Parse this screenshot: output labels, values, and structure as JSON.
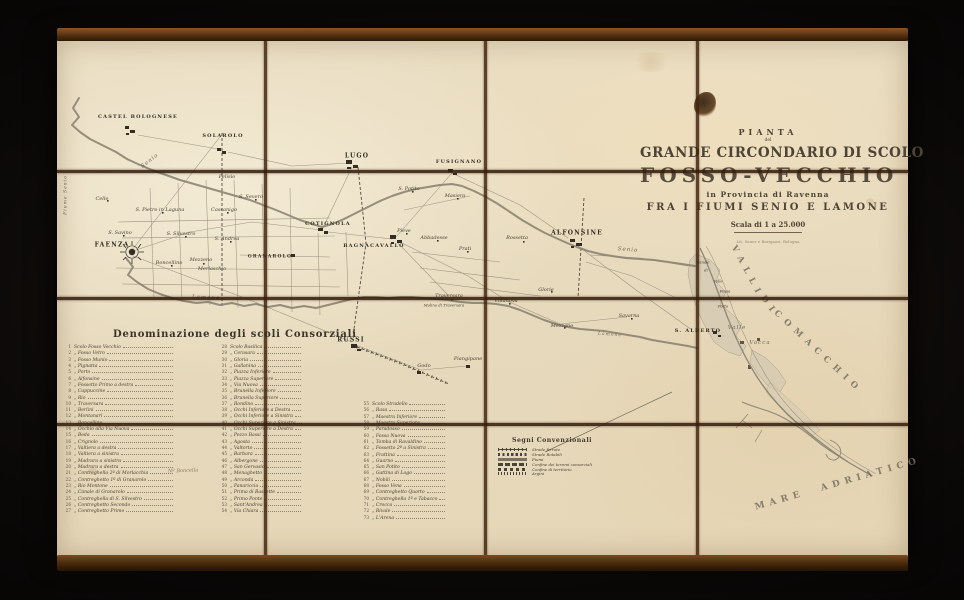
{
  "photo": {
    "paper_color": "#e9ddc1",
    "frame_color": "#51300f",
    "ink_color": "#3f392e",
    "background_color": "#0a0807"
  },
  "title_block": {
    "pianta": "PIANTA",
    "del": "del",
    "line1": "GRANDE CIRCONDARIO DI SCOLO",
    "line2": "FOSSO-VECCHIO",
    "line3": "in Provincia di Ravenna",
    "line4": "FRA I FIUMI SENIO E LAMONE",
    "scala": "Scala di 1 a 25.000",
    "imprint": "Lit. Sauer e Barigazzi, Bologna"
  },
  "scoli": {
    "heading": "Denominazione degli scoli Consorziali",
    "note": "Nº Boncella",
    "col1": [
      {
        "n": "1",
        "name": "Scolo Fosso Vecchio"
      },
      {
        "n": "2",
        "name": "„ Fosso Vetro"
      },
      {
        "n": "3",
        "name": "„ Fosso Munio"
      },
      {
        "n": "4",
        "name": "„ Pignatta"
      },
      {
        "n": "5",
        "name": "„ Porto"
      },
      {
        "n": "6",
        "name": "„ Alfonsine"
      },
      {
        "n": "7",
        "name": "„ Fossetto Primo a destra"
      },
      {
        "n": "8",
        "name": "„ Cappuccine"
      },
      {
        "n": "9",
        "name": "„ Rio"
      },
      {
        "n": "10",
        "name": "„ Traversara"
      },
      {
        "n": "11",
        "name": "„ Berlini"
      },
      {
        "n": "12",
        "name": "„ Montanari"
      },
      {
        "n": "13",
        "name": "„ Boncellino"
      },
      {
        "n": "14",
        "name": "„ Occhio alla Via Nuova"
      },
      {
        "n": "15",
        "name": "„ Beda"
      },
      {
        "n": "16",
        "name": "„ Crignolo"
      },
      {
        "n": "17",
        "name": "„ Valtiera a destra"
      },
      {
        "n": "18",
        "name": "„ Valtiera a sinistra"
      },
      {
        "n": "19",
        "name": "„ Madrara a sinistra"
      },
      {
        "n": "20",
        "name": "„ Madrara a destra"
      },
      {
        "n": "21",
        "name": "„ Contreghella 2ª di Morlacchia"
      },
      {
        "n": "22",
        "name": "„ Contreghetto 1º di Granarolo"
      },
      {
        "n": "23",
        "name": "„ Rio Montone"
      },
      {
        "n": "24",
        "name": "„ Canale di Granarolo"
      },
      {
        "n": "25",
        "name": "„ Contreghella di S. Silvestro"
      },
      {
        "n": "26",
        "name": "„ Contreghetto Secondo"
      },
      {
        "n": "27",
        "name": "„ Contreghetto Primo"
      }
    ],
    "col2": [
      {
        "n": "28",
        "name": "Scolo Basilica"
      },
      {
        "n": "29",
        "name": "„ Cerasara"
      },
      {
        "n": "30",
        "name": "„ Gloria"
      },
      {
        "n": "31",
        "name": "„ Gallanina"
      },
      {
        "n": "32",
        "name": "„ Piazza Inferiore"
      },
      {
        "n": "33",
        "name": "„ Piazza Superiore"
      },
      {
        "n": "34",
        "name": "„ Via Nuova"
      },
      {
        "n": "35",
        "name": "„ Brunella Inferiore"
      },
      {
        "n": "36",
        "name": "„ Brunella Superiore"
      },
      {
        "n": "37",
        "name": "„ Rondino"
      },
      {
        "n": "38",
        "name": "„ Occhi Inferiore a Destra"
      },
      {
        "n": "39",
        "name": "„ Occhi Inferiore a Sinistra"
      },
      {
        "n": "40",
        "name": "„ Occhi Superiore a Sinistra"
      },
      {
        "n": "41",
        "name": "„ Occhi Superiore a Destra"
      },
      {
        "n": "42",
        "name": "„ Pozzo Bassi"
      },
      {
        "n": "43",
        "name": "„ Agosta"
      },
      {
        "n": "44",
        "name": "„ Valtorto"
      },
      {
        "n": "45",
        "name": "„ Barbara"
      },
      {
        "n": "46",
        "name": "„ Albergone"
      },
      {
        "n": "47",
        "name": "„ San Gervasio"
      },
      {
        "n": "48",
        "name": "„ Menaghetto"
      },
      {
        "n": "49",
        "name": "„ Arconda"
      },
      {
        "n": "50",
        "name": "„ Panariccia"
      },
      {
        "n": "51",
        "name": "„ Prima di Bassette"
      },
      {
        "n": "52",
        "name": "„ Primo Ponte"
      },
      {
        "n": "53",
        "name": "„ Sant'Andrea"
      },
      {
        "n": "54",
        "name": "„ Via Chiara"
      }
    ],
    "col3": [
      {
        "n": "55",
        "name": "Scolo Stradello"
      },
      {
        "n": "56",
        "name": "„ Rasa"
      },
      {
        "n": "57",
        "name": "„ Maestra Inferiore"
      },
      {
        "n": "58",
        "name": "„ Maestra Superiore"
      },
      {
        "n": "59",
        "name": "„ Paradosso"
      },
      {
        "n": "60",
        "name": "„ Fossa Nuova"
      },
      {
        "n": "61",
        "name": "„ Tomba di Ravaldino"
      },
      {
        "n": "62",
        "name": "„ Fossetto 2º a Sinistra"
      },
      {
        "n": "63",
        "name": "„ Frattina"
      },
      {
        "n": "64",
        "name": "„ Guarno"
      },
      {
        "n": "65",
        "name": "„ San Potito"
      },
      {
        "n": "66",
        "name": "„ Gattina di Lago"
      },
      {
        "n": "67",
        "name": "„ Nobili"
      },
      {
        "n": "68",
        "name": "„ Fosso Vena"
      },
      {
        "n": "69",
        "name": "„ Contreghetto Quarto"
      },
      {
        "n": "70",
        "name": "„ Contreghella 1ª e Tabacco"
      },
      {
        "n": "71",
        "name": "„ Crocca"
      },
      {
        "n": "72",
        "name": "„ Rivale"
      },
      {
        "n": "73",
        "name": "„ L'Arena"
      }
    ]
  },
  "legend": {
    "title": "Segni Convenzionali",
    "items": [
      {
        "sym": "sym-rail",
        "label": "Strade ferrate"
      },
      {
        "sym": "sym-road",
        "label": "Strade Rotabili"
      },
      {
        "sym": "sym-river",
        "label": "Fiumi"
      },
      {
        "sym": "sym-conf1",
        "label": "Confine dei terreni consorziali"
      },
      {
        "sym": "sym-conf2",
        "label": "Confine di territorio"
      },
      {
        "sym": "sym-argini",
        "label": "Argini"
      }
    ]
  },
  "map": {
    "labels": [
      {
        "text": "CASTEL BOLOGNESE",
        "cls": "town",
        "style": {
          "left": "138px",
          "top": "117px",
          "fontSize": "5px"
        }
      },
      {
        "text": "SOLAROLO",
        "cls": "town",
        "style": {
          "left": "223px",
          "top": "136px",
          "fontSize": "5px"
        }
      },
      {
        "text": "LUGO",
        "cls": "town",
        "style": {
          "left": "357px",
          "top": "156px"
        }
      },
      {
        "text": "FUSIGNANO",
        "cls": "town",
        "style": {
          "left": "459px",
          "top": "162px",
          "fontSize": "5px"
        }
      },
      {
        "text": "COTIGNOLA",
        "cls": "town",
        "style": {
          "left": "328px",
          "top": "224px",
          "fontSize": "5px"
        }
      },
      {
        "text": "BAGNACAVALLO",
        "cls": "town",
        "style": {
          "left": "374px",
          "top": "246px",
          "fontSize": "5px"
        }
      },
      {
        "text": "GRANAROLO",
        "cls": "town",
        "style": {
          "left": "270px",
          "top": "257px",
          "fontSize": "4.5px"
        }
      },
      {
        "text": "FAENZA",
        "cls": "town",
        "style": {
          "left": "112px",
          "top": "245px"
        }
      },
      {
        "text": "ALFONSINE",
        "cls": "town",
        "style": {
          "left": "577px",
          "top": "233px"
        }
      },
      {
        "text": "RUSSI",
        "cls": "town",
        "style": {
          "left": "351px",
          "top": "340px"
        }
      },
      {
        "text": "S. ALBERTO",
        "cls": "town",
        "style": {
          "left": "698px",
          "top": "331px",
          "fontSize": "5px"
        }
      },
      {
        "text": "Felisio",
        "cls": "village",
        "style": {
          "left": "227px",
          "top": "177px"
        }
      },
      {
        "text": "S. Severo",
        "cls": "village",
        "style": {
          "left": "251px",
          "top": "197px"
        }
      },
      {
        "text": "S. Pietro in Laguna",
        "cls": "village",
        "style": {
          "left": "160px",
          "top": "210px"
        }
      },
      {
        "text": "Cassanigo",
        "cls": "village",
        "style": {
          "left": "224px",
          "top": "210px"
        }
      },
      {
        "text": "Celle",
        "cls": "village",
        "style": {
          "left": "102px",
          "top": "199px"
        }
      },
      {
        "text": "S. Savino",
        "cls": "village",
        "style": {
          "left": "120px",
          "top": "233px"
        }
      },
      {
        "text": "S. Silvestro",
        "cls": "village",
        "style": {
          "left": "181px",
          "top": "234px"
        }
      },
      {
        "text": "S. Andrea",
        "cls": "village",
        "style": {
          "left": "227px",
          "top": "239px"
        }
      },
      {
        "text": "Boncellino",
        "cls": "village",
        "style": {
          "left": "169px",
          "top": "263px"
        }
      },
      {
        "text": "Mezzeno",
        "cls": "village",
        "style": {
          "left": "201px",
          "top": "260px"
        }
      },
      {
        "text": "Merlaschio",
        "cls": "village",
        "style": {
          "left": "212px",
          "top": "269px"
        }
      },
      {
        "text": "S. Potito",
        "cls": "village",
        "style": {
          "left": "409px",
          "top": "189px"
        }
      },
      {
        "text": "Masiera",
        "cls": "village",
        "style": {
          "left": "455px",
          "top": "196px"
        }
      },
      {
        "text": "Pieve",
        "cls": "village",
        "style": {
          "left": "404px",
          "top": "231px"
        }
      },
      {
        "text": "Abbadesse",
        "cls": "village",
        "style": {
          "left": "434px",
          "top": "238px"
        }
      },
      {
        "text": "Prati",
        "cls": "village",
        "style": {
          "left": "465px",
          "top": "249px"
        }
      },
      {
        "text": "Rossetta",
        "cls": "village",
        "style": {
          "left": "517px",
          "top": "238px"
        }
      },
      {
        "text": "Glorie",
        "cls": "village",
        "style": {
          "left": "546px",
          "top": "290px"
        }
      },
      {
        "text": "Villanova",
        "cls": "village",
        "style": {
          "left": "506px",
          "top": "301px"
        }
      },
      {
        "text": "Traversara",
        "cls": "village",
        "style": {
          "left": "449px",
          "top": "296px"
        }
      },
      {
        "text": "Molino di Traversara",
        "cls": "village tiny",
        "style": {
          "left": "444px",
          "top": "305px"
        }
      },
      {
        "text": "Mezzano",
        "cls": "village",
        "style": {
          "left": "562px",
          "top": "326px"
        }
      },
      {
        "text": "Savarna",
        "cls": "village",
        "style": {
          "left": "629px",
          "top": "316px"
        }
      },
      {
        "text": "Godo",
        "cls": "village",
        "style": {
          "left": "424px",
          "top": "366px"
        }
      },
      {
        "text": "Piangipane",
        "cls": "village",
        "style": {
          "left": "468px",
          "top": "359px"
        }
      },
      {
        "text": "Canale",
        "cls": "village tiny",
        "style": {
          "left": "703px",
          "top": "262px"
        }
      },
      {
        "text": "di",
        "cls": "village tiny",
        "style": {
          "left": "706px",
          "top": "270px"
        }
      },
      {
        "text": "Valle",
        "cls": "village tiny",
        "style": {
          "left": "718px",
          "top": "281px"
        }
      },
      {
        "text": "Fossa",
        "cls": "village tiny",
        "style": {
          "left": "725px",
          "top": "291px"
        }
      },
      {
        "text": "di",
        "cls": "village tiny",
        "style": {
          "left": "728px",
          "top": "298px"
        }
      },
      {
        "text": "Porto",
        "cls": "village tiny",
        "style": {
          "left": "723px",
          "top": "306px"
        }
      },
      {
        "text": "Valle",
        "cls": "water",
        "style": {
          "left": "737px",
          "top": "328px"
        }
      },
      {
        "text": "Vacca",
        "cls": "water",
        "style": {
          "left": "760px",
          "top": "343px"
        }
      },
      {
        "text": "Senio",
        "cls": "water",
        "style": {
          "left": "150px",
          "top": "161px",
          "transform": "translate(-50%,-50%) rotate(-38deg)"
        }
      },
      {
        "text": "Senio",
        "cls": "water",
        "style": {
          "left": "628px",
          "top": "250px",
          "transform": "translate(-50%,-50%) rotate(5deg)"
        }
      },
      {
        "text": "Lamone",
        "cls": "water",
        "style": {
          "left": "206px",
          "top": "298px",
          "transform": "translate(-50%,-50%) rotate(3deg)"
        }
      },
      {
        "text": "Lamone",
        "cls": "water",
        "style": {
          "left": "610px",
          "top": "335px",
          "transform": "translate(-50%,-50%) rotate(4deg)",
          "fontSize": "4.5px"
        }
      },
      {
        "text": "Fiume Senio",
        "cls": "water",
        "style": {
          "left": "66px",
          "top": "195px",
          "transform": "translate(-50%,-50%) rotate(-90deg)",
          "fontSize": "4.5px"
        }
      },
      {
        "text": "VALLI",
        "cls": "valli",
        "style": {
          "left": "747px",
          "top": "272px",
          "transform": "translate(-50%,-50%) rotate(62deg)"
        }
      },
      {
        "text": "DI",
        "cls": "valli",
        "style": {
          "left": "769px",
          "top": "306px",
          "transform": "translate(-50%,-50%) rotate(55deg)"
        }
      },
      {
        "text": "COMACCHIO",
        "cls": "valli",
        "style": {
          "left": "818px",
          "top": "352px",
          "transform": "translate(-50%,-50%) rotate(43deg)"
        }
      },
      {
        "text": "MARE ADRIATICO",
        "cls": "sea",
        "style": {
          "left": "838px",
          "top": "484px",
          "transform": "translate(-50%,-50%) rotate(-16deg)"
        }
      }
    ]
  }
}
